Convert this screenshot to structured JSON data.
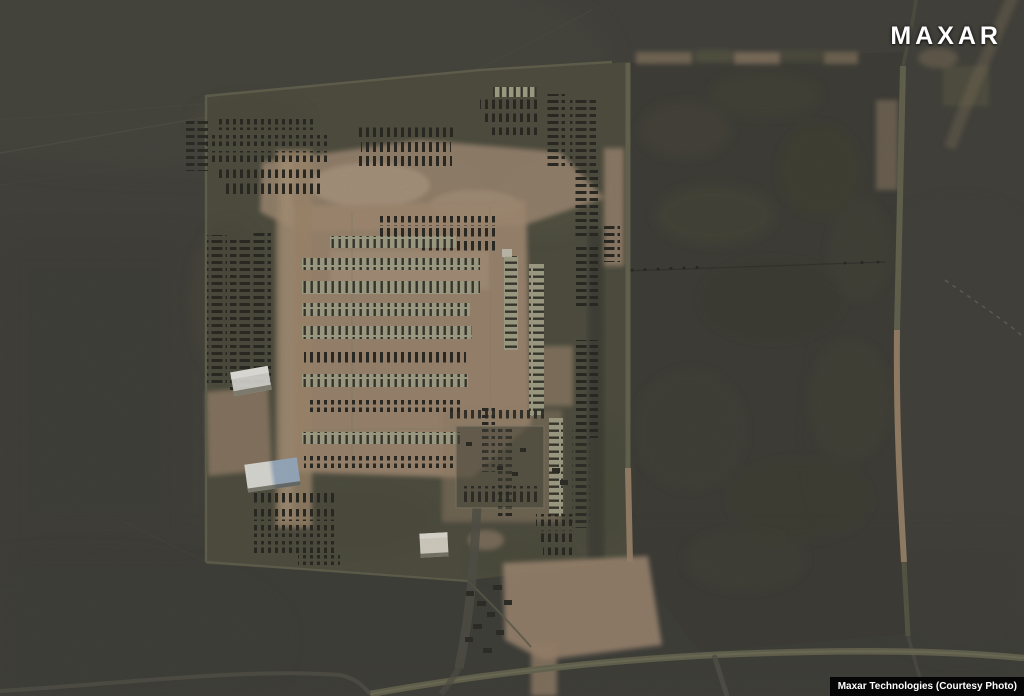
{
  "image": {
    "type": "satellite-photo",
    "description": "Overhead satellite view of a military vehicle staging area: rows and columns of parked vehicles on tan dirt inside a fenced compound, white-roofed buildings, dirt and olive roads, and an adjacent empty field bounded by tracks.",
    "credit_logo": "MAXAR",
    "caption": "Maxar Technologies (Courtesy Photo)"
  },
  "colors": {
    "terrain": "#4b4a43",
    "field": "#46453e",
    "compound": "#595847",
    "dirt": "#b29980",
    "dirt_light": "#c3ab93",
    "road_olive": "#72715a",
    "road_tan": "#ab9176",
    "road_gray": "#5c5b51",
    "vehicle_dark": "#2f2e28",
    "row_light": "#b2b095",
    "building_white": "#f3f2ec",
    "building_blue": "#a9bdd2",
    "logo_color": "#ffffff",
    "caption_bg": "#060606",
    "caption_color": "#ffffff"
  },
  "features": {
    "clusters": [
      "vehicle-rows-top-left",
      "vehicle-rows-top-middle",
      "vehicle-rows-top-right",
      "vehicle-columns-left",
      "vehicle-rows-central",
      "vehicle-columns-inner-right",
      "vehicle-columns-right",
      "vehicle-rows-bottom-left",
      "vehicle-pen-bottom-middle",
      "vehicles-along-south-road"
    ],
    "buildings": [
      "white-building-upper",
      "white-blue-building-lower",
      "white-building-south"
    ],
    "roads": [
      "compound-perimeter",
      "central-dirt-road",
      "east-compound-road",
      "field-east-road",
      "south-olive-road",
      "power-line-track"
    ]
  }
}
